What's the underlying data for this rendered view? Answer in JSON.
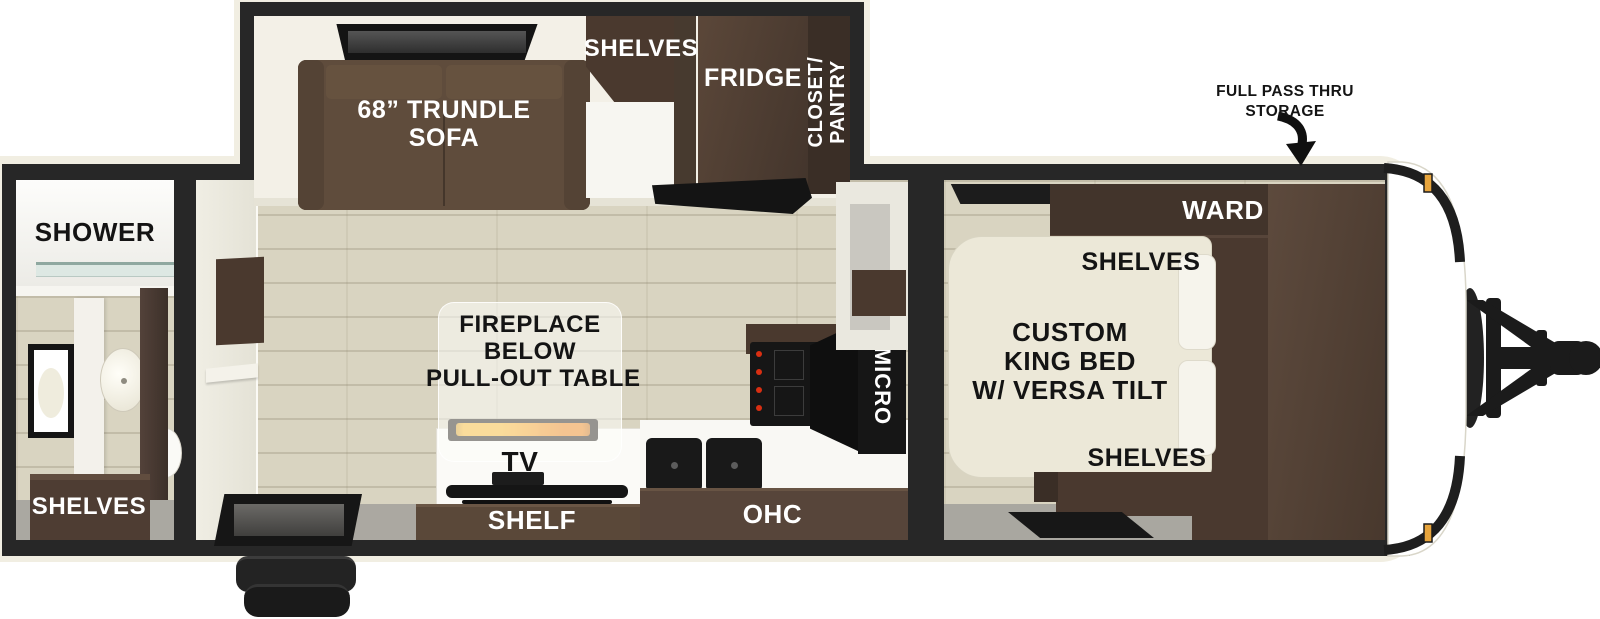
{
  "floorplan": {
    "bathroom": {
      "shower": "SHOWER",
      "shelves": "SHELVES"
    },
    "living_area": {
      "sofa_line1": "68” TRUNDLE",
      "sofa_line2": "SOFA",
      "shelves": "SHELVES",
      "fridge": "FRIDGE",
      "closet_line1": "CLOSET/",
      "closet_line2": "PANTRY",
      "table_line1": "FIREPLACE",
      "table_line2": "BELOW",
      "table_line3": "PULL-OUT TABLE",
      "tv": "TV",
      "shelf": "SHELF",
      "ohc": "OHC",
      "micro": "MICRO"
    },
    "bedroom": {
      "bed_line1": "CUSTOM",
      "bed_line2": "KING BED",
      "bed_line3": "W/ VERSA TILT",
      "ward": "WARD",
      "shelves_top": "SHELVES",
      "shelves_bottom": "SHELVES"
    },
    "exterior": {
      "storage_line1": "FULL PASS THRU",
      "storage_line2": "STORAGE"
    }
  },
  "colors": {
    "wall_black": "#272727",
    "exterior_skin": "#f1eee2",
    "floor_wood": "#d9d4c1",
    "floor_gray": "#aaa8a1",
    "furniture_brown": "#5a4639",
    "cabinet_dark_brown": "#42342b",
    "bed_cream": "#ece8d8",
    "flame_orange": "#f0931b",
    "marker_amber": "#e7a43c",
    "burner_red": "#d92f12"
  }
}
